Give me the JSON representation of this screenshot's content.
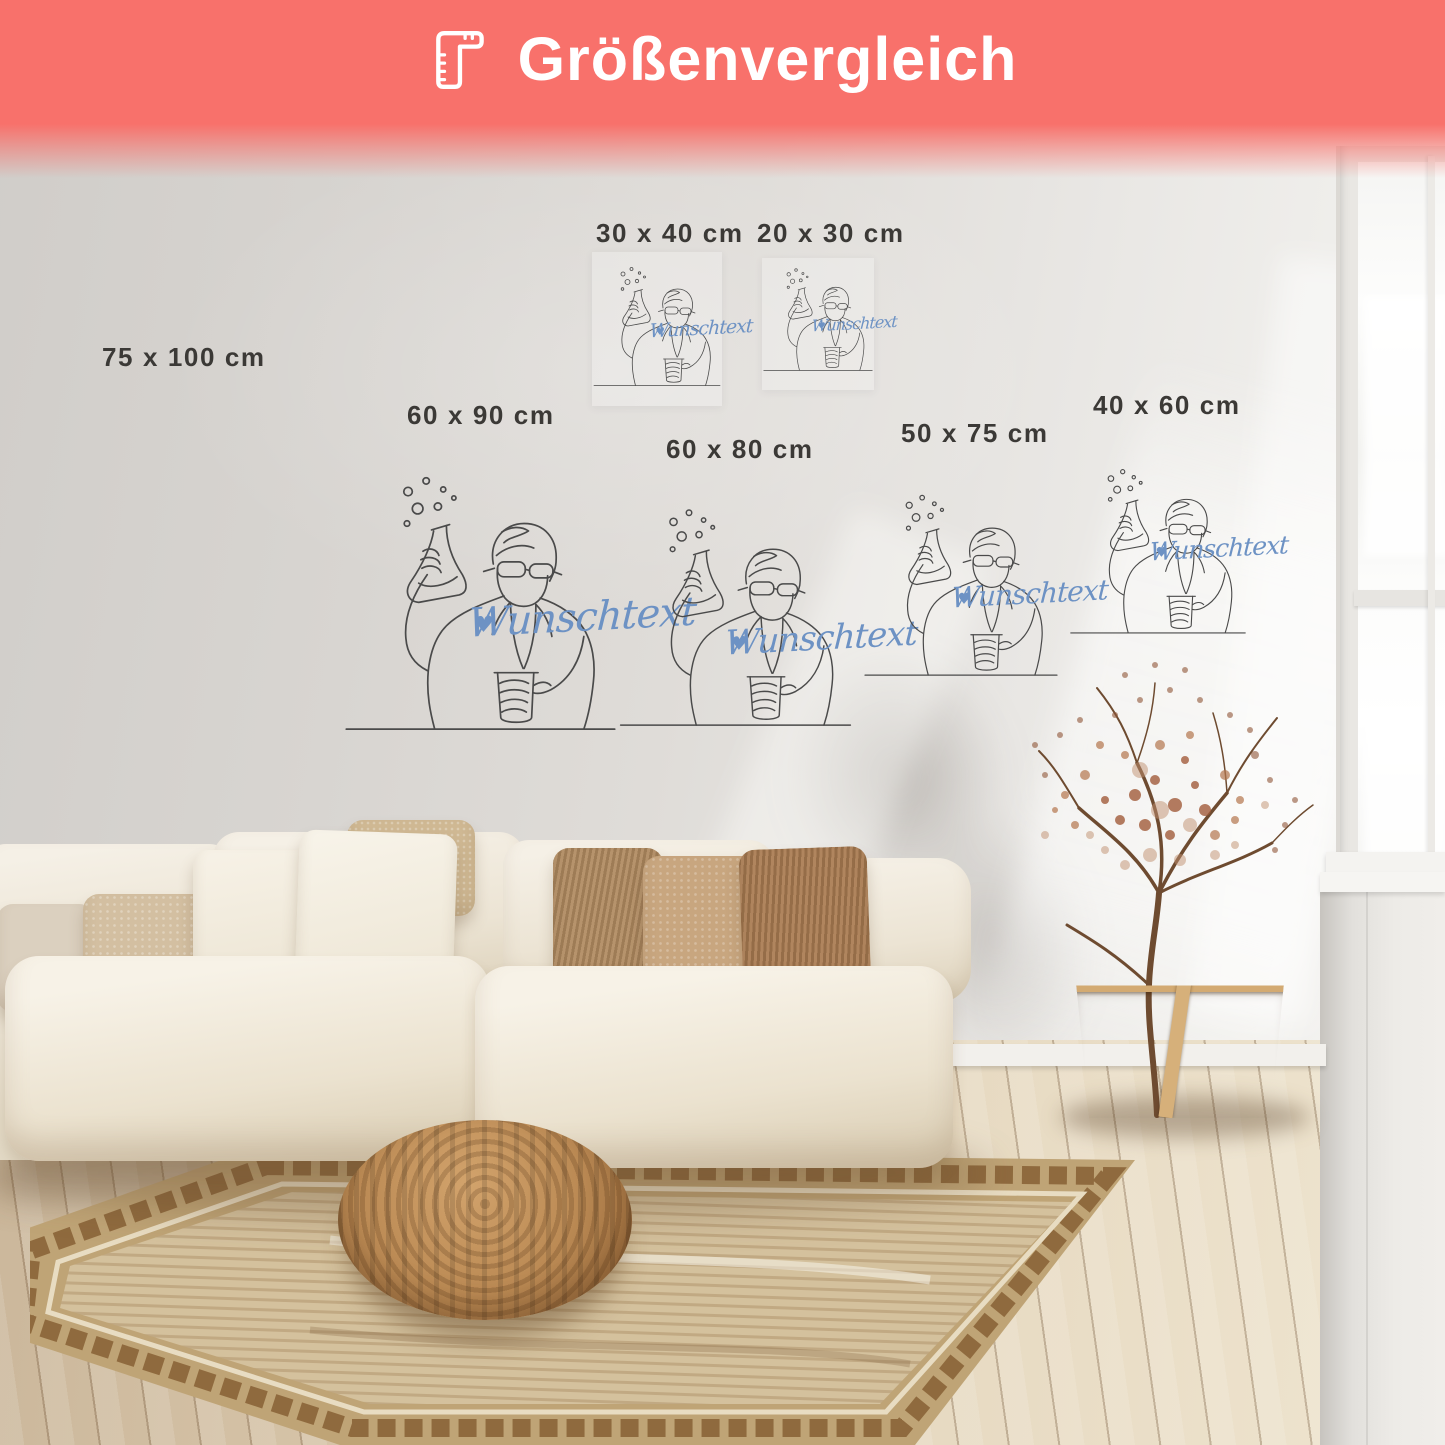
{
  "banner": {
    "title": "Größenvergleich",
    "icon": "ruler-icon",
    "background_color": "#F8716B",
    "text_color": "#FFFFFF"
  },
  "artwork": {
    "script_text": "Wunschtext",
    "heart": "♥",
    "script_color": "#6D92C4",
    "line_color": "#4A4A4A",
    "motif": "one-line drawing of a chemist in goggles raising a bubbling Erlenmeyer flask and holding a beaker"
  },
  "posters": [
    {
      "id": "75x100",
      "size_label": "75 x 100 cm"
    },
    {
      "id": "30x40",
      "size_label": "30 x 40 cm"
    },
    {
      "id": "20x30",
      "size_label": "20 x 30 cm"
    },
    {
      "id": "60x90",
      "size_label": "60 x 90 cm"
    },
    {
      "id": "60x80",
      "size_label": "60 x 80 cm"
    },
    {
      "id": "50x75",
      "size_label": "50 x 75 cm"
    },
    {
      "id": "40x60",
      "size_label": "40 x 60 cm"
    }
  ]
}
